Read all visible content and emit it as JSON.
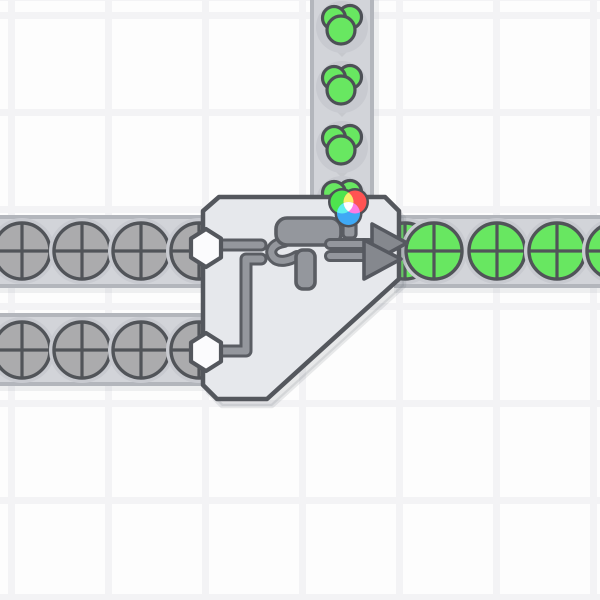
{
  "scene": {
    "width": 600,
    "height": 600,
    "colors": {
      "background": "#fdfdfd",
      "grid_line": "#f3f3f5",
      "belt": "#d2d4d9",
      "belt_edge": "#b3b6bc",
      "belt_shadow": "rgba(110,115,125,0.10)",
      "item_halo": "#c8cad0",
      "item_outline": "#515459",
      "blob_outline": "#4d5056",
      "shape_gray": "#ababad",
      "shape_green": "#68e761",
      "paint_green": "#68e761",
      "building_fill": "#e6e8ec",
      "building_outline": "#54575d",
      "building_shadow": "rgba(100,105,115,0.14)",
      "hex_fill": "#fbfbfd",
      "pipe_core": "#94979d",
      "pipe_edge": "#5a5d63",
      "icon_fill": "#94979d",
      "icon_edge": "#5a5d63",
      "arrow_fill": "#85888e",
      "arrow_edge": "#565960",
      "chevron": "#c6c8cd",
      "wheel_outline": "#4e5157",
      "wheel_green": "#4ee44e",
      "wheel_red": "#ff5353",
      "wheel_blue": "#3fa9f5",
      "wheel_yellow": "#f7ef6a",
      "wheel_cyan": "#5ef0ee",
      "wheel_magenta": "#ff7ae2",
      "wheel_center": "#ffffff"
    },
    "grid": {
      "period": 97,
      "line_width": 7,
      "offset_x": 8,
      "offset_y": 12
    },
    "belts": [
      {
        "name": "paint-supply-belt",
        "dir": "down",
        "x": 310,
        "y": 0,
        "length": 202,
        "width": 64,
        "chevron_tops": [
          40,
          100,
          161
        ],
        "items": [
          {
            "type": "paint-blob",
            "x": 342,
            "y": 25
          },
          {
            "type": "paint-blob",
            "x": 342,
            "y": 85
          },
          {
            "type": "paint-blob",
            "x": 342,
            "y": 145
          },
          {
            "type": "paint-blob",
            "x": 342,
            "y": 200
          }
        ]
      },
      {
        "name": "shape-input-belt-upper",
        "dir": "right",
        "x": 0,
        "y": 215,
        "length": 206,
        "width": 73,
        "chevron_tops": [],
        "items": [
          {
            "type": "circle",
            "color": "gray",
            "x": 22,
            "y": 251
          },
          {
            "type": "circle",
            "color": "gray",
            "x": 82,
            "y": 251
          },
          {
            "type": "circle",
            "color": "gray",
            "x": 141,
            "y": 251
          },
          {
            "type": "circle",
            "color": "gray",
            "x": 199,
            "y": 251
          }
        ]
      },
      {
        "name": "shape-input-belt-lower",
        "dir": "right",
        "x": 0,
        "y": 313,
        "length": 206,
        "width": 73,
        "chevron_tops": [],
        "items": [
          {
            "type": "circle",
            "color": "gray",
            "x": 22,
            "y": 350
          },
          {
            "type": "circle",
            "color": "gray",
            "x": 82,
            "y": 350
          },
          {
            "type": "circle",
            "color": "gray",
            "x": 141,
            "y": 350
          },
          {
            "type": "circle",
            "color": "gray",
            "x": 199,
            "y": 350
          }
        ]
      },
      {
        "name": "output-belt",
        "dir": "right",
        "x": 394,
        "y": 215,
        "length": 206,
        "width": 73,
        "chevron_tops": [],
        "items": [
          {
            "type": "circle",
            "color": "green",
            "x": 405,
            "y": 251
          },
          {
            "type": "circle",
            "color": "green",
            "x": 434,
            "y": 251
          },
          {
            "type": "circle",
            "color": "green",
            "x": 497,
            "y": 251
          },
          {
            "type": "circle",
            "color": "green",
            "x": 557,
            "y": 251
          },
          {
            "type": "circle",
            "color": "green",
            "x": 615,
            "y": 251
          }
        ]
      }
    ],
    "building": {
      "name": "painter-building",
      "outline": [
        [
          219,
          197
        ],
        [
          385,
          197
        ],
        [
          399,
          211
        ],
        [
          399,
          279
        ],
        [
          267,
          399
        ],
        [
          217,
          399
        ],
        [
          203,
          385
        ],
        [
          203,
          211
        ]
      ],
      "outline_stroke_width": 4.5,
      "shadow_offset": [
        5,
        7
      ],
      "hex_inputs": [
        [
          206,
          248
        ],
        [
          206,
          352
        ]
      ],
      "hex_rx": 15,
      "hex_ry": 19,
      "pipes": [
        [
          [
            219,
            245
          ],
          [
            261,
            245
          ]
        ],
        [
          [
            221,
            351
          ],
          [
            246,
            351
          ],
          [
            246,
            259
          ],
          [
            261,
            259
          ]
        ]
      ],
      "roller": {
        "body": [
          276,
          218,
          65,
          27,
          11
        ],
        "handle": [
          296,
          250,
          19,
          39,
          7
        ],
        "arm": "M284,242 C272,244 268,252 274,258 C279,263 289,261 297,256"
      },
      "arrow": {
        "bars": [
          [
            [
              330,
              244
            ],
            [
              369,
              244
            ]
          ],
          [
            [
              330,
              256
            ],
            [
              369,
              256
            ]
          ]
        ],
        "heads": [
          [
            [
              372,
              224
            ],
            [
              372,
              262
            ],
            [
              407,
              243
            ]
          ],
          [
            [
              364,
              240
            ],
            [
              364,
              279
            ],
            [
              401,
              259
            ]
          ]
        ]
      },
      "wheel": {
        "stem": [
          343,
          221,
          13,
          17,
          4
        ],
        "ring_r": 14,
        "r": 11.5,
        "centers": {
          "green": [
            342,
            202
          ],
          "red": [
            355,
            202
          ],
          "blue": [
            348.5,
            213.5
          ]
        }
      }
    }
  }
}
